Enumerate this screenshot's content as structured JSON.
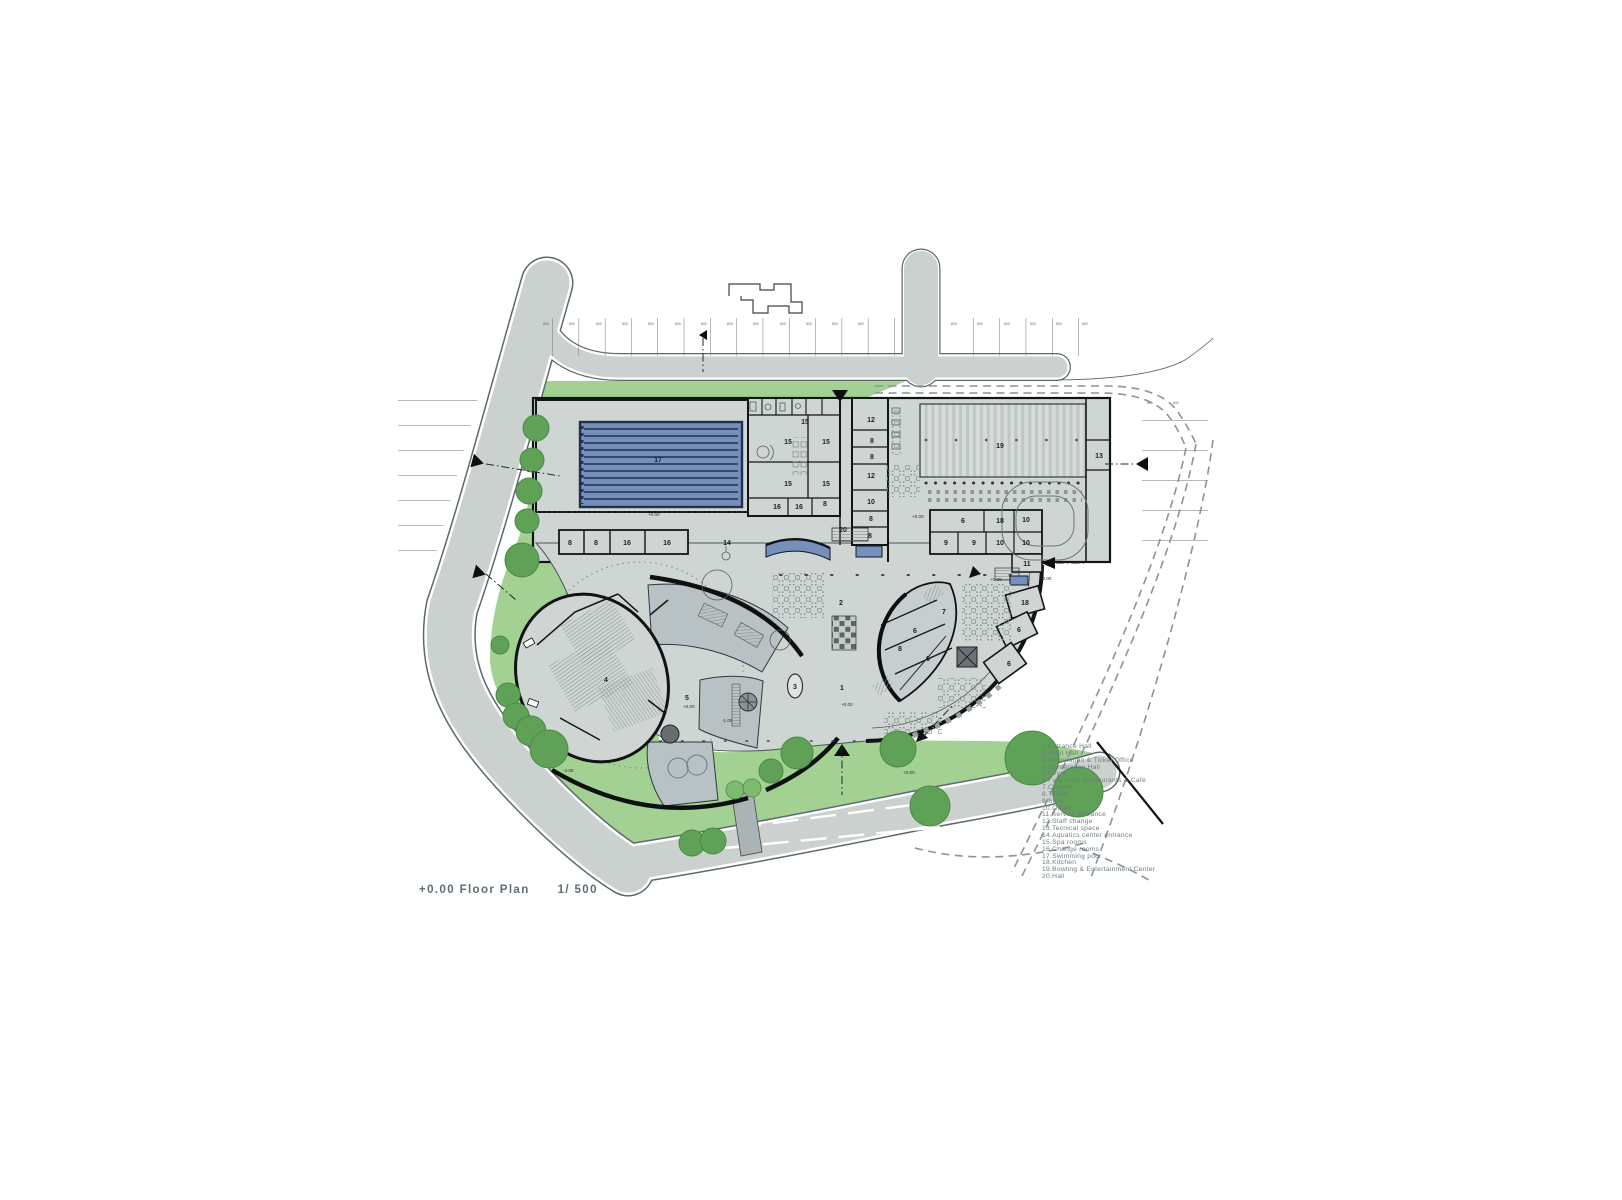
{
  "title": {
    "label": "+0.00 Floor Plan",
    "scale": "1/ 500"
  },
  "legend": {
    "items": [
      "1.Entrance Hall",
      "2.Main Hall",
      "3.Information & Ticket Office",
      "4.Conference Hall",
      "5.Foyer",
      "6.Fast Food Restaurants & Cafe",
      "7.Cinema",
      "8.Toilets",
      "9.Shop",
      "10.Office",
      "11.Service entrance",
      "12.Staff change",
      "13.Tecnical space",
      "14.Aquatics center entrance",
      "15.Spa rooms",
      "16.Change rooms",
      "17.Swimming pool",
      "18.Kitchen",
      "19.Bowling & Entertainment Center",
      "20.Hall"
    ]
  },
  "colors": {
    "green": "#a2d193",
    "tree": "#5fa156",
    "tree_stroke": "#4a8a47",
    "tree_light": "#7ebb70",
    "road": "#cbd1ce",
    "floor": "#cfd5d2",
    "terrace": "#b8c1c3",
    "pool_blue": "#7590bb",
    "pool_dark": "#22304f",
    "wall": "#121517",
    "accent_blue": "#7590bb",
    "dashed_road": "#8b9496",
    "legend_text": "#6e7d82",
    "title_text": "#5d6d74"
  },
  "plan": {
    "room_labels": [
      {
        "n": "17",
        "x": 658,
        "y": 462
      },
      {
        "n": "8",
        "x": 570,
        "y": 545
      },
      {
        "n": "8",
        "x": 596,
        "y": 545
      },
      {
        "n": "16",
        "x": 627,
        "y": 545
      },
      {
        "n": "16",
        "x": 667,
        "y": 545
      },
      {
        "n": "14",
        "x": 727,
        "y": 545
      },
      {
        "n": "15",
        "x": 805,
        "y": 424
      },
      {
        "n": "15",
        "x": 788,
        "y": 444
      },
      {
        "n": "15",
        "x": 826,
        "y": 444
      },
      {
        "n": "15",
        "x": 788,
        "y": 486
      },
      {
        "n": "15",
        "x": 826,
        "y": 486
      },
      {
        "n": "16",
        "x": 777,
        "y": 509
      },
      {
        "n": "16",
        "x": 799,
        "y": 509
      },
      {
        "n": "8",
        "x": 825,
        "y": 506
      },
      {
        "n": "12",
        "x": 871,
        "y": 422
      },
      {
        "n": "8",
        "x": 872,
        "y": 443
      },
      {
        "n": "8",
        "x": 872,
        "y": 459
      },
      {
        "n": "12",
        "x": 871,
        "y": 478
      },
      {
        "n": "10",
        "x": 871,
        "y": 504
      },
      {
        "n": "8",
        "x": 871,
        "y": 521
      },
      {
        "n": "8",
        "x": 870,
        "y": 538
      },
      {
        "n": "20",
        "x": 843,
        "y": 532
      },
      {
        "n": "19",
        "x": 1000,
        "y": 448
      },
      {
        "n": "13",
        "x": 1099,
        "y": 458
      },
      {
        "n": "6",
        "x": 963,
        "y": 523
      },
      {
        "n": "18",
        "x": 1000,
        "y": 523
      },
      {
        "n": "10",
        "x": 1026,
        "y": 522
      },
      {
        "n": "9",
        "x": 946,
        "y": 545
      },
      {
        "n": "9",
        "x": 974,
        "y": 545
      },
      {
        "n": "10",
        "x": 1000,
        "y": 545
      },
      {
        "n": "10",
        "x": 1026,
        "y": 545
      },
      {
        "n": "11",
        "x": 1027,
        "y": 566
      },
      {
        "n": "18",
        "x": 1025,
        "y": 605
      },
      {
        "n": "6",
        "x": 1019,
        "y": 632
      },
      {
        "n": "6",
        "x": 1009,
        "y": 666
      },
      {
        "n": "7",
        "x": 944,
        "y": 614
      },
      {
        "n": "6",
        "x": 915,
        "y": 633
      },
      {
        "n": "8",
        "x": 900,
        "y": 651
      },
      {
        "n": "6",
        "x": 928,
        "y": 661
      },
      {
        "n": "2",
        "x": 841,
        "y": 605
      },
      {
        "n": "1",
        "x": 842,
        "y": 690
      },
      {
        "n": "3",
        "x": 795,
        "y": 689
      },
      {
        "n": "4",
        "x": 606,
        "y": 682
      },
      {
        "n": "5",
        "x": 687,
        "y": 700
      }
    ],
    "elevation_markers": [
      {
        "t": "+0.00",
        "x": 648,
        "y": 516
      },
      {
        "t": "+0.00",
        "x": 912,
        "y": 518
      },
      {
        "t": "+0.00",
        "x": 990,
        "y": 581
      },
      {
        "t": "+0.00",
        "x": 841,
        "y": 706
      },
      {
        "t": "-1.00",
        "x": 722,
        "y": 722
      },
      {
        "t": "+0.00",
        "x": 903,
        "y": 774
      },
      {
        "t": "-4.00",
        "x": 563,
        "y": 772
      },
      {
        "t": "-2.00",
        "x": 1041,
        "y": 580
      },
      {
        "t": "+0.00",
        "x": 683,
        "y": 708
      }
    ],
    "parking_dims": {
      "label": "800",
      "positions": [
        [
          543,
          325
        ],
        [
          569,
          325
        ],
        [
          596,
          325
        ],
        [
          622,
          325
        ],
        [
          648,
          325
        ],
        [
          675,
          325
        ],
        [
          701,
          325
        ],
        [
          727,
          325
        ],
        [
          753,
          325
        ],
        [
          780,
          325
        ],
        [
          806,
          325
        ],
        [
          832,
          325
        ],
        [
          858,
          325
        ],
        [
          951,
          325
        ],
        [
          977,
          325
        ],
        [
          1004,
          325
        ],
        [
          1030,
          325
        ],
        [
          1056,
          325
        ],
        [
          1082,
          325
        ],
        [
          1147,
          404
        ],
        [
          1173,
          404
        ]
      ]
    }
  }
}
